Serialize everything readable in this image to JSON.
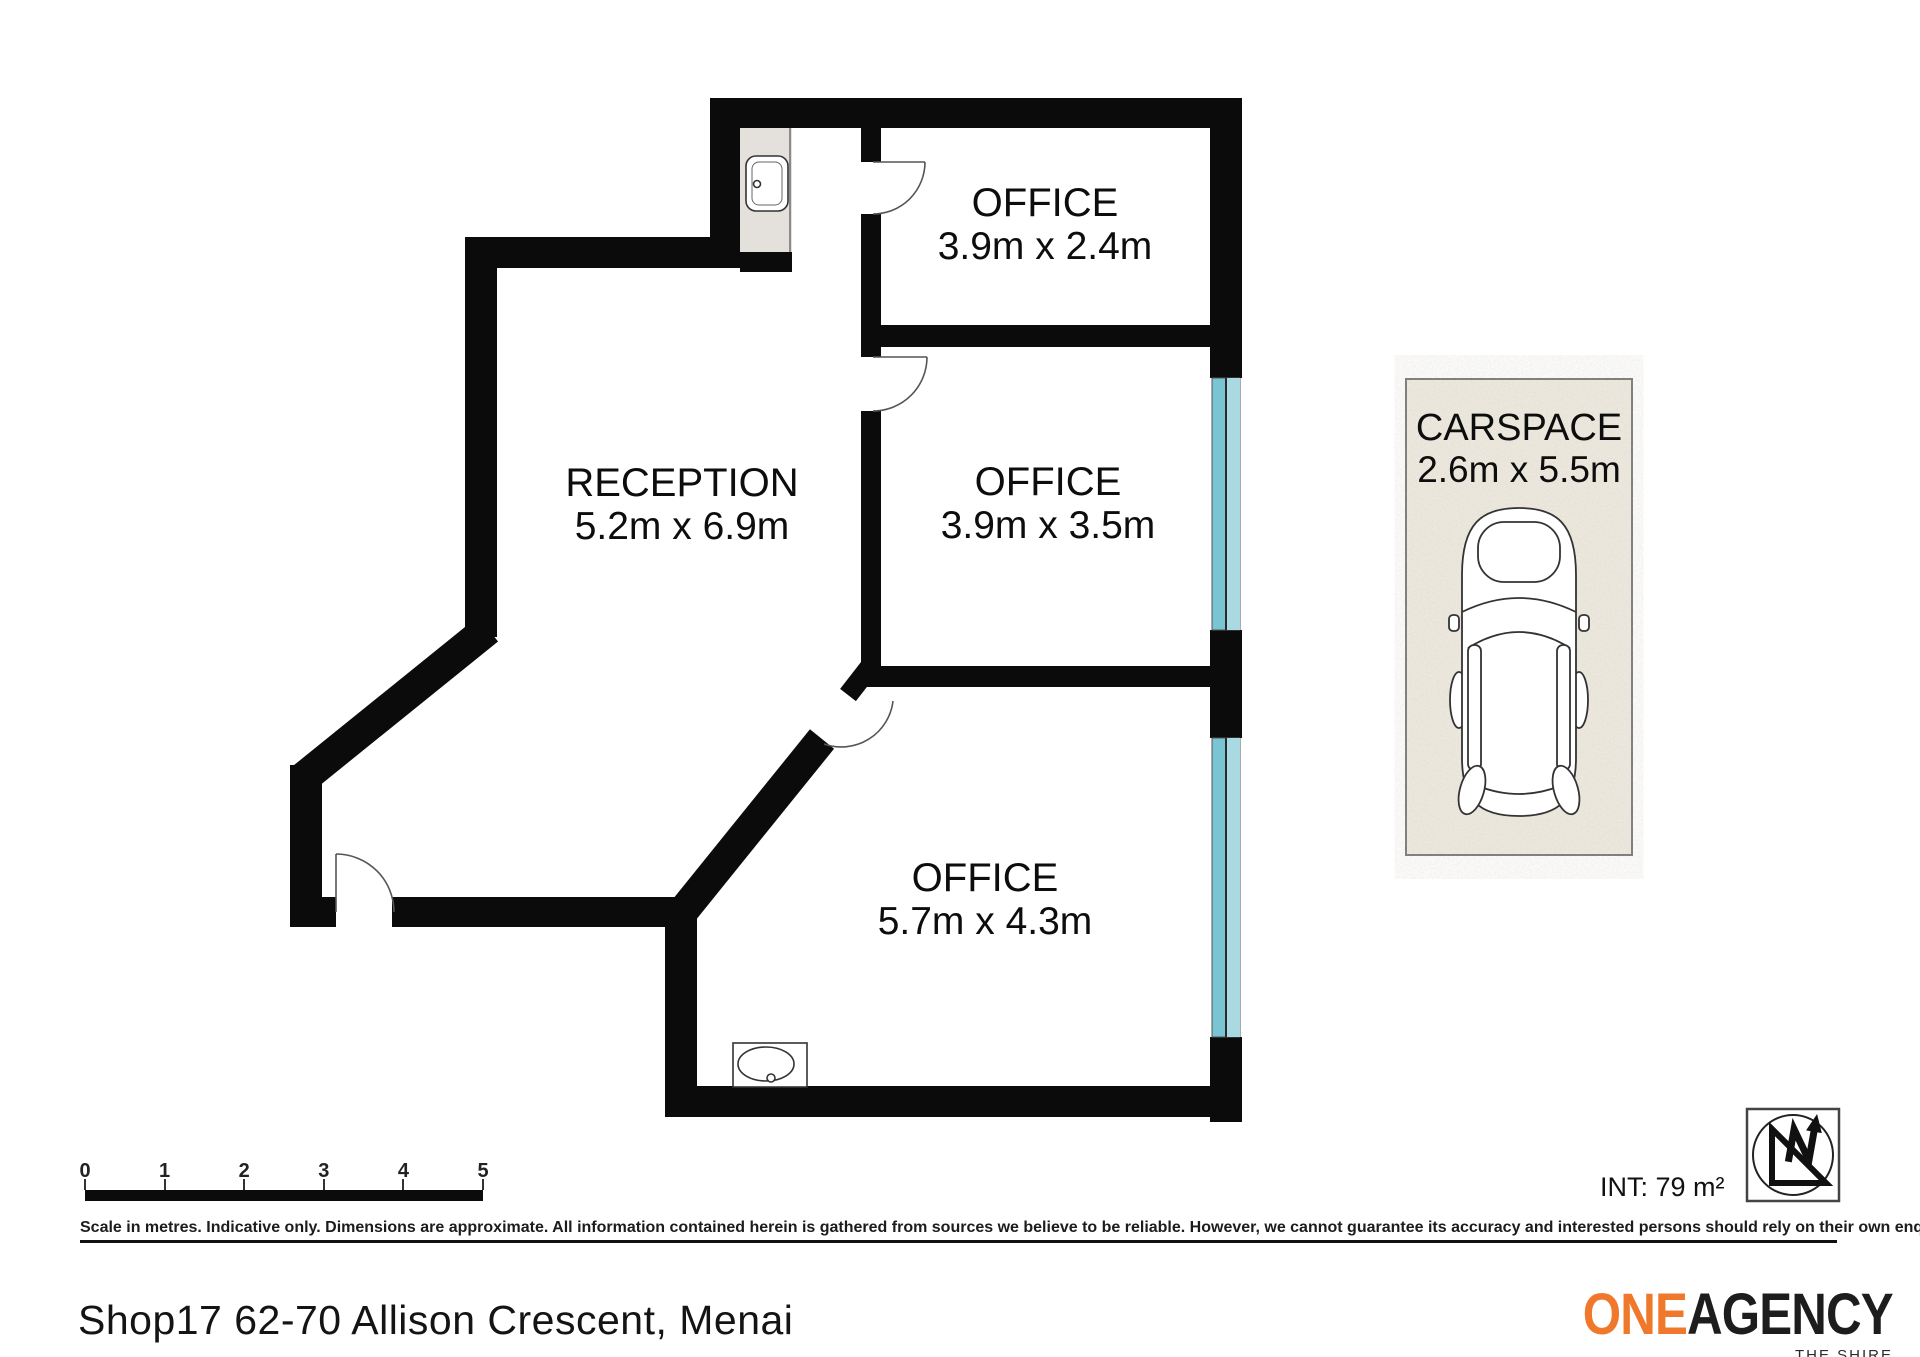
{
  "plan": {
    "rooms": [
      {
        "id": "office-top",
        "name": "OFFICE",
        "dims": "3.9m x 2.4m"
      },
      {
        "id": "office-middle",
        "name": "OFFICE",
        "dims": "3.9m x 3.5m"
      },
      {
        "id": "office-bottom",
        "name": "OFFICE",
        "dims": "5.7m x 4.3m"
      },
      {
        "id": "reception",
        "name": "RECEPTION",
        "dims": "5.2m x 6.9m"
      }
    ],
    "carspace": {
      "name": "CARSPACE",
      "dims": "2.6m x 5.5m"
    }
  },
  "scale_bar": {
    "labels": [
      "0",
      "1",
      "2",
      "3",
      "4",
      "5"
    ]
  },
  "disclaimer": "Scale in metres. Indicative only. Dimensions are approximate. All information contained herein is gathered from sources we believe to be reliable. However, we cannot guarantee its accuracy and interested persons should rely on their own enquiries.",
  "footer": {
    "address": "Shop17 62-70 Allison Crescent, Menai",
    "internal_area": "INT: 79 m²"
  },
  "logo": {
    "one": "ONE",
    "agency": "AGENCY",
    "tagline": "THE SHIRE"
  },
  "icons": {
    "north_arrow": "north-arrow-icon",
    "car": "car-top-view-icon",
    "sink": "sink-icon",
    "vanity_basin": "basin-icon",
    "window": "window-glass"
  },
  "colors": {
    "wall": "#0b0b0b",
    "window_glass_dark": "#79C5D3",
    "window_glass_light": "#A9DAE2",
    "carspace_bg": "#EFEBE1",
    "alcove_floor": "#E4E1DC",
    "logo_orange": "#F0782C"
  }
}
